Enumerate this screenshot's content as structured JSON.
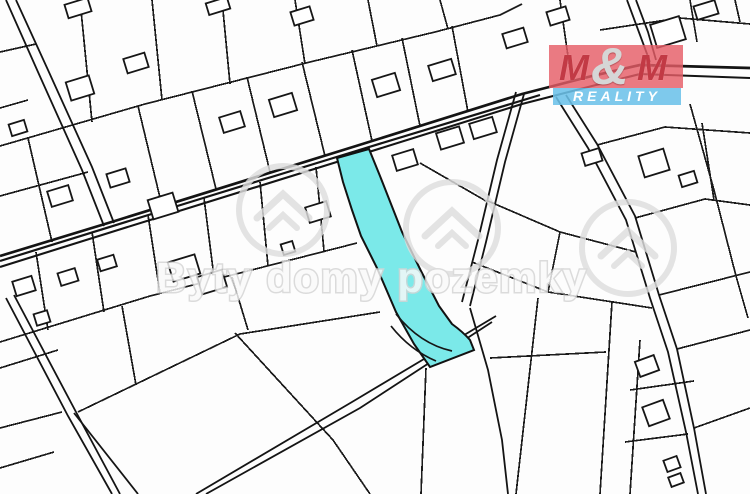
{
  "map": {
    "kind": "cadastral parcel map",
    "background_color": "#fdfdfd",
    "parcel_line_color": "#1b1b1b",
    "highlighted_parcel": {
      "fill": "#7be9e9",
      "outline": "#121212",
      "description": "elongated strip parcel highlighted in cyan, center of map"
    }
  },
  "watermark": {
    "text": "Byty domy pozemky",
    "color": "#d8d8d8",
    "icon": "house-in-circle-icon",
    "icon_count": 3
  },
  "logo": {
    "top_left": "M",
    "amp": "&",
    "top_right": "M",
    "bottom": "REALITY",
    "red_bg": "#e55d66",
    "blue_bg": "#6cc1e9",
    "m_color": "#c23a45",
    "amp_color": "#d6d6d6",
    "reality_color": "#ffffff"
  }
}
